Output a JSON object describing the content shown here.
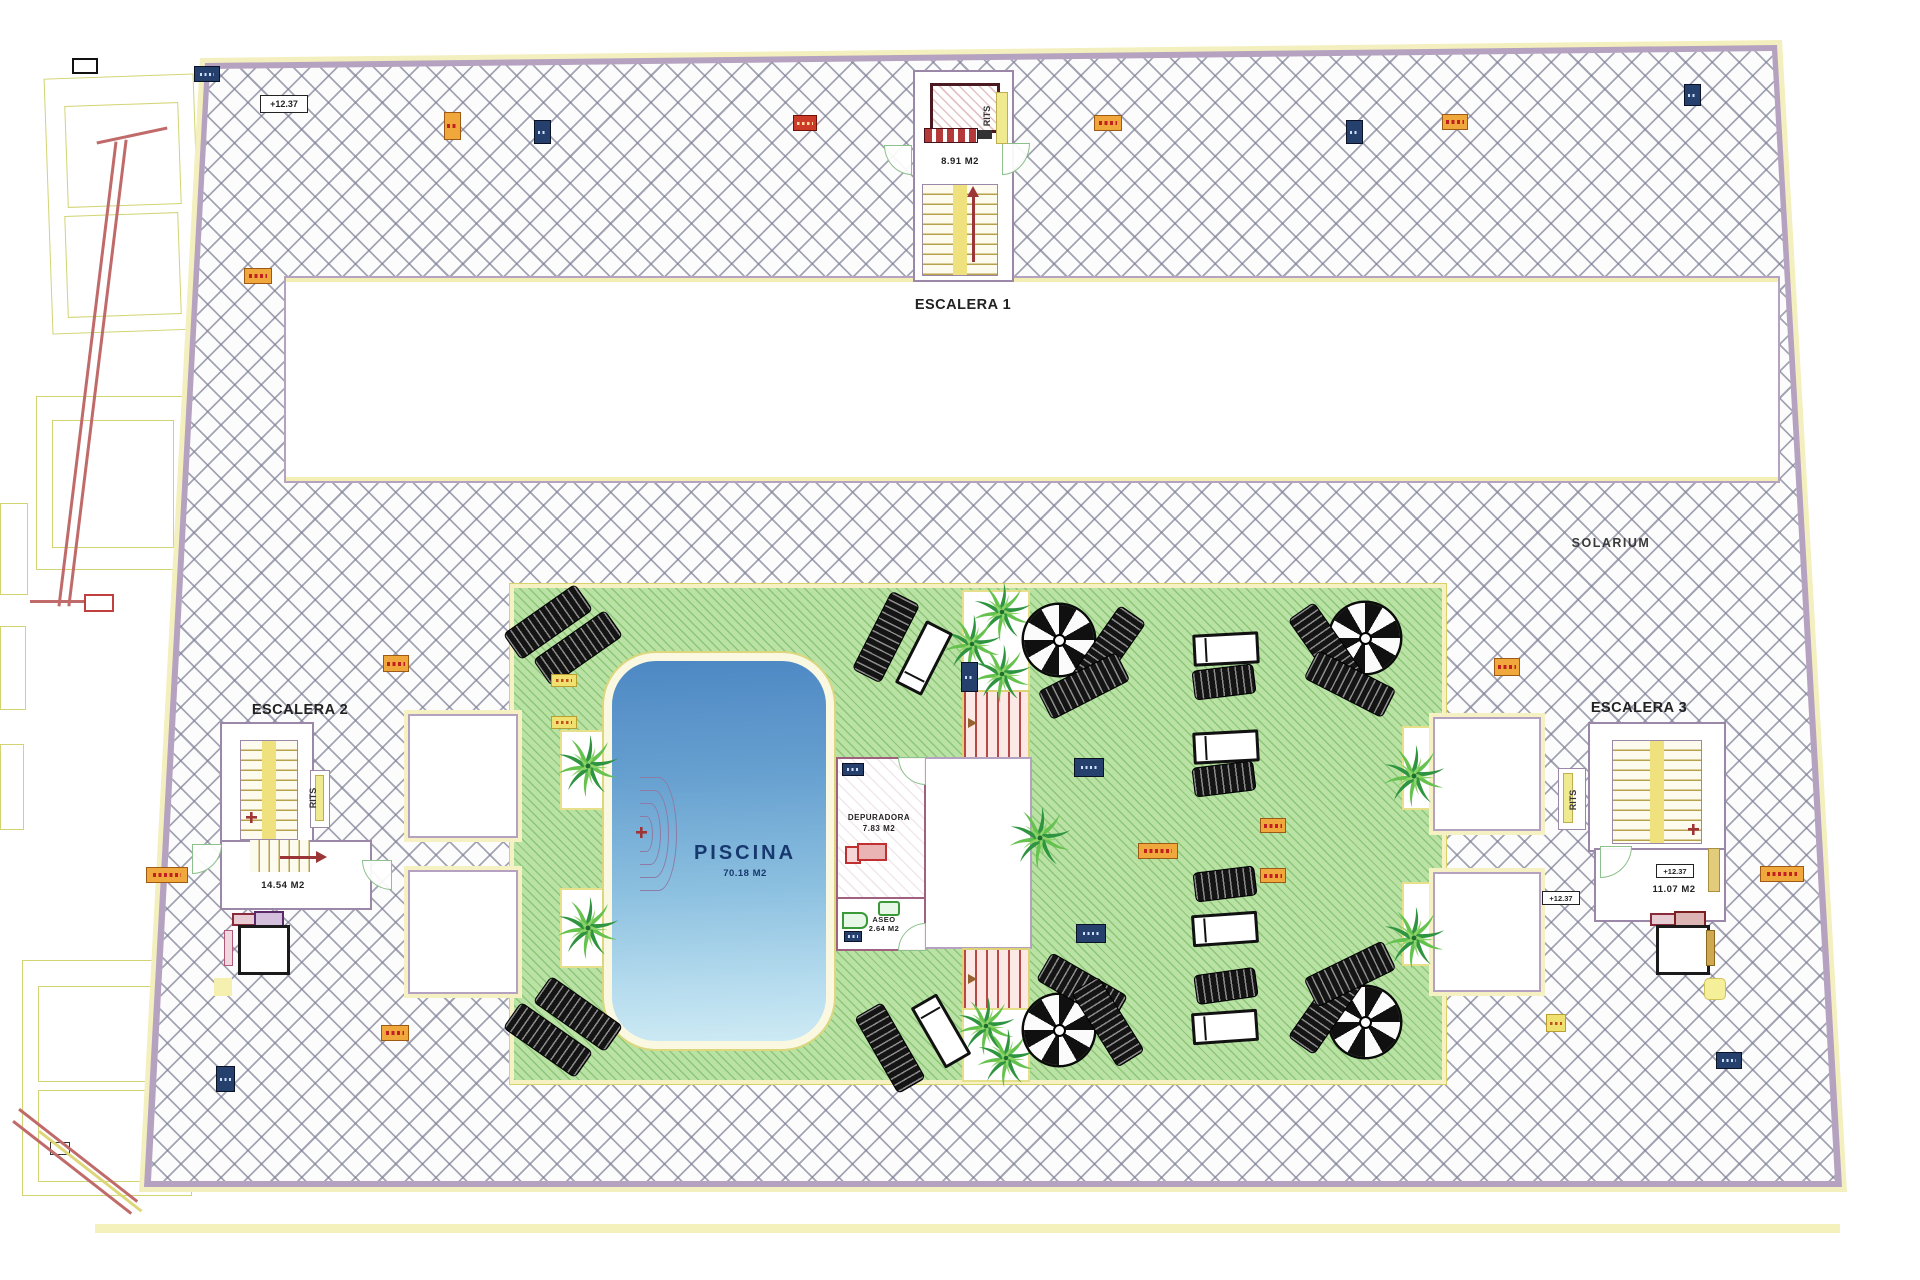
{
  "labels": {
    "escalera1": "ESCALERA 1",
    "escalera2": "ESCALERA 2",
    "escalera3": "ESCALERA 3",
    "solarium": "SOLARIUM",
    "rits": "RITS",
    "elevation": "+12.37"
  },
  "pool": {
    "name": "PISCINA",
    "area": "70.18 M2"
  },
  "rooms": {
    "depuradora": {
      "name": "DEPURADORA",
      "area": "7.83 M2"
    },
    "aseo": {
      "name": "ASEO",
      "area": "2.64 M2"
    }
  },
  "stairs": {
    "escalera1": {
      "landing_area": "8.91 M2"
    },
    "escalera2": {
      "landing_area": "14.54 M2"
    },
    "escalera3": {
      "landing_area": "11.07 M2"
    }
  },
  "palette": {
    "hatch_line": "#7d8096",
    "deck_background": "#fcfcfd",
    "boundary_purple": "#b5a2c0",
    "boundary_yellow": "#f4efbe",
    "green_deck": "#b9e2a4",
    "green_hatch_line": "#68b054",
    "pool_blue_top": "#4e88c4",
    "pool_blue_bottom": "#cdeaf4",
    "stair_yellow": "#efe27e",
    "marker_orange": "#f0a83c",
    "marker_navy": "#26406e",
    "marker_red": "#cc3a2a",
    "parasol_black": "#101010",
    "palm_green": "#2f9440",
    "label_text": "#222222",
    "pool_label_text": "#16386e"
  }
}
